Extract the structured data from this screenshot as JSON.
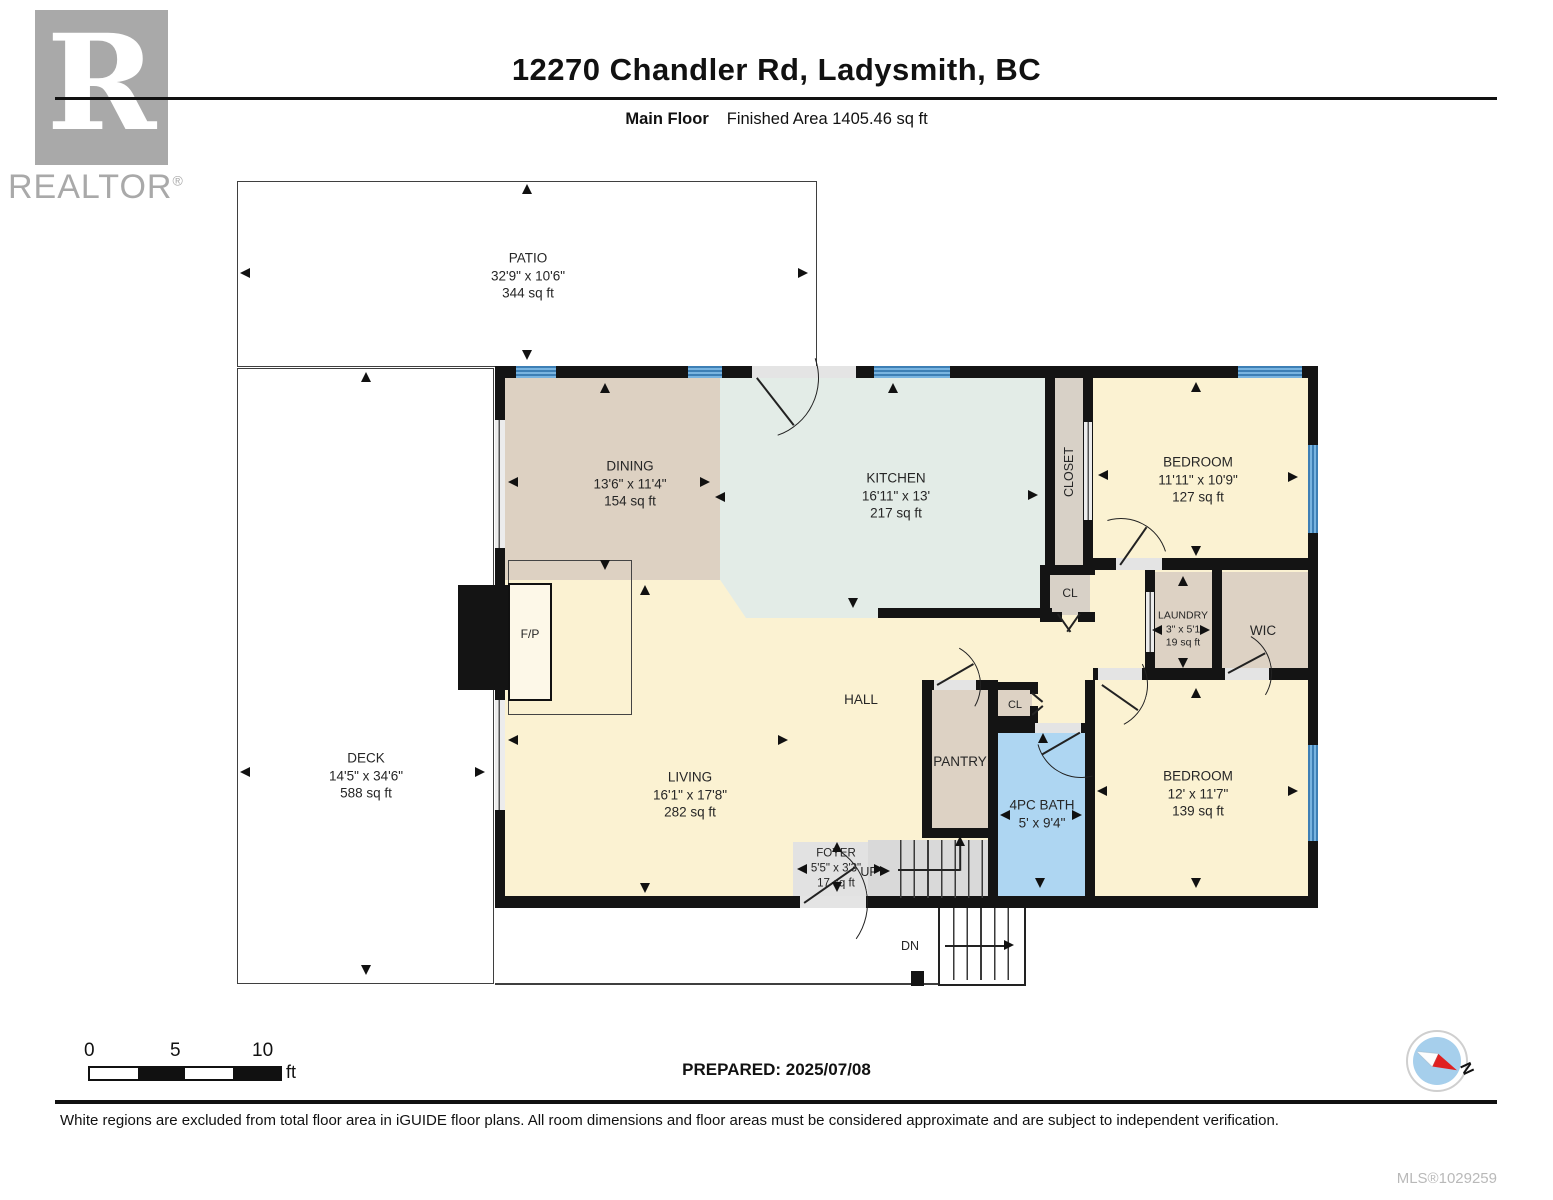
{
  "header": {
    "title": "12270 Chandler Rd, Ladysmith, BC",
    "floor_label": "Main Floor",
    "area_label": "Finished Area 1405.46 sq ft"
  },
  "logo": {
    "letter": "R",
    "brand": "REALTOR",
    "registered": "®"
  },
  "rooms": {
    "patio": {
      "name": "PATIO",
      "dims": "32'9\" x 10'6\"",
      "area": "344 sq ft"
    },
    "deck": {
      "name": "DECK",
      "dims": "14'5\" x 34'6\"",
      "area": "588 sq ft"
    },
    "dining": {
      "name": "DINING",
      "dims": "13'6\" x 11'4\"",
      "area": "154 sq ft"
    },
    "kitchen": {
      "name": "KITCHEN",
      "dims": "16'11\" x 13'",
      "area": "217 sq ft"
    },
    "closet": {
      "name": "CLOSET"
    },
    "bedroom1": {
      "name": "BEDROOM",
      "dims": "11'11\" x 10'9\"",
      "area": "127 sq ft"
    },
    "closet_hall": {
      "name": "CL"
    },
    "laundry": {
      "name": "LAUNDRY",
      "dims": "3\" x 5'1",
      "area": "19 sq ft"
    },
    "wic": {
      "name": "WIC"
    },
    "hall": {
      "name": "HALL"
    },
    "pantry": {
      "name": "PANTRY"
    },
    "closet_small": {
      "name": "CL"
    },
    "bath": {
      "name": "4PC BATH",
      "dims": "5' x 9'4\""
    },
    "bedroom2": {
      "name": "BEDROOM",
      "dims": "12' x 11'7\"",
      "area": "139 sq ft"
    },
    "living": {
      "name": "LIVING",
      "dims": "16'1\" x 17'8\"",
      "area": "282 sq ft"
    },
    "foyer": {
      "name": "FOYER",
      "dims": "5'5\" x 3'3\"",
      "area": "17 sq ft"
    },
    "fireplace": {
      "name": "F/P"
    }
  },
  "stairs": {
    "up_label": "UP",
    "down_label": "DN"
  },
  "scale_bar": {
    "ticks": [
      "0",
      "5",
      "10"
    ],
    "unit": "ft"
  },
  "footer": {
    "prepared": "PREPARED: 2025/07/08",
    "disclaimer": "White regions are excluded from total floor area in iGUIDE floor plans. All room dimensions and floor areas must be considered approximate and are subject to independent verification.",
    "mls": "MLS®1029259",
    "compass_label": "N"
  },
  "colors": {
    "wall": "#141414",
    "window_blue": "#5aa0d6",
    "room_yellow": "#fbf2d2",
    "room_tan": "#ddd1c2",
    "room_mint": "#e3ece7",
    "bath_blue": "#aed6f2",
    "stairs_gray": "#dcdcdc",
    "logo_gray": "#a9a9a9"
  }
}
